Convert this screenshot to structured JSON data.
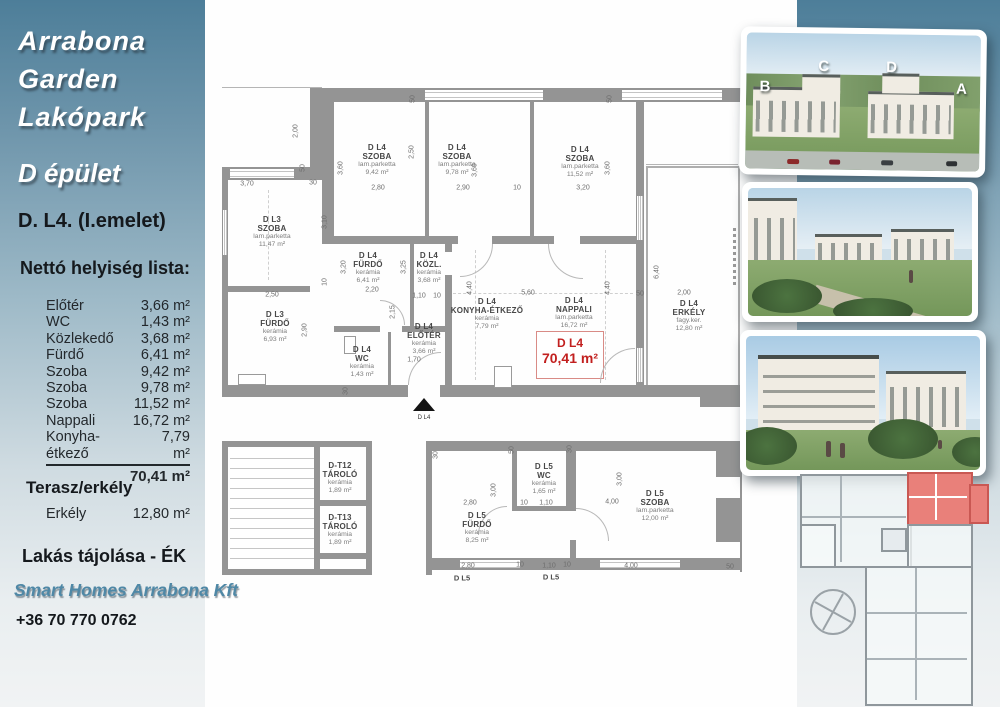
{
  "sidebar": {
    "logo_lines": [
      "Arrabona",
      "Garden",
      "Lakópark"
    ],
    "building": "D épület",
    "unit_title": "D. L4. (I.emelet)",
    "list_title": "Nettó helyiség lista:",
    "rooms": [
      {
        "label": "Előtér",
        "value": "3,66 m²"
      },
      {
        "label": "WC",
        "value": "1,43 m²"
      },
      {
        "label": "Közlekedő",
        "value": "3,68 m²"
      },
      {
        "label": "Fürdő",
        "value": "6,41 m²"
      },
      {
        "label": "Szoba",
        "value": "9,42 m²"
      },
      {
        "label": "Szoba",
        "value": "9,78 m²"
      },
      {
        "label": "Szoba",
        "value": "11,52 m²"
      },
      {
        "label": "Nappali",
        "value": "16,72 m²"
      },
      {
        "label": "Konyha-étkező",
        "value": "7,79 m²"
      }
    ],
    "total": "70,41 m²",
    "terrace_title": "Terasz/erkély",
    "terrace_label": "Erkély",
    "terrace_value": "12,80 m²",
    "orientation": "Lakás tájolása - ÉK",
    "company": "Smart Homes Arrabona Kft",
    "phone": "+36 70 770 0762"
  },
  "floorplan": {
    "unit_box": {
      "line1": "D L4",
      "line2": "70,41 m²"
    },
    "entrance_label": "D L4",
    "rooms": [
      {
        "id": "dl3-szoba",
        "x": 272,
        "y": 232,
        "lines": [
          "D L3",
          "SZOBA",
          "lam.parketta",
          "11,47 m²"
        ]
      },
      {
        "id": "dl4-szoba-1",
        "x": 377,
        "y": 160,
        "lines": [
          "D L4",
          "SZOBA",
          "lam.parketta",
          "9,42 m²"
        ]
      },
      {
        "id": "dl4-szoba-2",
        "x": 457,
        "y": 160,
        "lines": [
          "D L4",
          "SZOBA",
          "lam.parketta",
          "9,78 m²"
        ]
      },
      {
        "id": "dl4-szoba-3",
        "x": 580,
        "y": 162,
        "lines": [
          "D L4",
          "SZOBA",
          "lam.parketta",
          "11,52 m²"
        ]
      },
      {
        "id": "dl3-furdo",
        "x": 275,
        "y": 327,
        "lines": [
          "D L3",
          "FÜRDŐ",
          "kerámia",
          "6,93 m²"
        ]
      },
      {
        "id": "dl4-furdo",
        "x": 368,
        "y": 268,
        "lines": [
          "D L4",
          "FÜRDŐ",
          "kerámia",
          "6,41 m²"
        ]
      },
      {
        "id": "dl4-kozl",
        "x": 429,
        "y": 268,
        "lines": [
          "D L4",
          "KÖZL.",
          "kerámia",
          "3,68 m²"
        ]
      },
      {
        "id": "dl4-wc",
        "x": 362,
        "y": 362,
        "lines": [
          "D L4",
          "WC",
          "kerámia",
          "1,43 m²"
        ]
      },
      {
        "id": "dl4-eloter",
        "x": 424,
        "y": 339,
        "lines": [
          "D L4",
          "ELŐTÉR",
          "kerámia",
          "3,66 m²"
        ]
      },
      {
        "id": "dl4-konyha",
        "x": 487,
        "y": 314,
        "lines": [
          "D L4",
          "KONYHA-ÉTKEZŐ",
          "kerámia",
          "7,79 m²"
        ]
      },
      {
        "id": "dl4-nappali",
        "x": 574,
        "y": 313,
        "lines": [
          "D L4",
          "NAPPALI",
          "lam.parketta",
          "16,72 m²"
        ]
      },
      {
        "id": "dl4-erkely",
        "x": 689,
        "y": 316,
        "lines": [
          "D L4",
          "ERKÉLY",
          "fagy.ker.",
          "12,80 m²"
        ]
      },
      {
        "id": "dt12-tarolo",
        "x": 340,
        "y": 478,
        "lines": [
          "D-T12",
          "TÁROLÓ",
          "kerámia",
          "1,89 m²"
        ]
      },
      {
        "id": "dt13-tarolo",
        "x": 340,
        "y": 530,
        "lines": [
          "D-T13",
          "TÁROLÓ",
          "kerámia",
          "1,89 m²"
        ]
      },
      {
        "id": "dl5-wc",
        "x": 544,
        "y": 479,
        "lines": [
          "D L5",
          "WC",
          "kerámia",
          "1,65 m²"
        ]
      },
      {
        "id": "dl5-furdo",
        "x": 477,
        "y": 528,
        "lines": [
          "D L5",
          "FÜRDŐ",
          "kerámia",
          "8,25 m²"
        ]
      },
      {
        "id": "dl5-szoba",
        "x": 655,
        "y": 506,
        "lines": [
          "D L5",
          "SZOBA",
          "lam.parketta",
          "12,00 m²"
        ]
      }
    ],
    "dims": [
      {
        "t": "3,70",
        "x": 247,
        "y": 184
      },
      {
        "t": "2,00",
        "x": 296,
        "y": 131,
        "r": 1
      },
      {
        "t": "50",
        "x": 303,
        "y": 168,
        "r": 1
      },
      {
        "t": "30",
        "x": 313,
        "y": 183
      },
      {
        "t": "3,60",
        "x": 341,
        "y": 168,
        "r": 1
      },
      {
        "t": "2,80",
        "x": 378,
        "y": 188
      },
      {
        "t": "2,50",
        "x": 412,
        "y": 152,
        "r": 1
      },
      {
        "t": "2,90",
        "x": 463,
        "y": 188
      },
      {
        "t": "3,60",
        "x": 475,
        "y": 170,
        "r": 1
      },
      {
        "t": "50",
        "x": 413,
        "y": 99,
        "r": 1
      },
      {
        "t": "50",
        "x": 610,
        "y": 99,
        "r": 1
      },
      {
        "t": "10",
        "x": 517,
        "y": 188
      },
      {
        "t": "3,20",
        "x": 583,
        "y": 188
      },
      {
        "t": "3,60",
        "x": 608,
        "y": 168,
        "r": 1
      },
      {
        "t": "3,10",
        "x": 325,
        "y": 222,
        "r": 1
      },
      {
        "t": "3,20",
        "x": 344,
        "y": 267,
        "r": 1
      },
      {
        "t": "2,20",
        "x": 372,
        "y": 290
      },
      {
        "t": "3,25",
        "x": 404,
        "y": 267,
        "r": 1
      },
      {
        "t": "1,10",
        "x": 419,
        "y": 296
      },
      {
        "t": "10",
        "x": 437,
        "y": 296
      },
      {
        "t": "2,50",
        "x": 272,
        "y": 295
      },
      {
        "t": "2,90",
        "x": 305,
        "y": 330,
        "r": 1
      },
      {
        "t": "10",
        "x": 325,
        "y": 282,
        "r": 1
      },
      {
        "t": "4,40",
        "x": 470,
        "y": 288,
        "r": 1
      },
      {
        "t": "5,60",
        "x": 528,
        "y": 293
      },
      {
        "t": "4,40",
        "x": 608,
        "y": 288,
        "r": 1
      },
      {
        "t": "6,40",
        "x": 657,
        "y": 272,
        "r": 1
      },
      {
        "t": "50",
        "x": 640,
        "y": 294
      },
      {
        "t": "2,00",
        "x": 684,
        "y": 293
      },
      {
        "t": "2,15",
        "x": 393,
        "y": 312,
        "r": 1
      },
      {
        "t": "1,70",
        "x": 414,
        "y": 360
      },
      {
        "t": "30",
        "x": 346,
        "y": 391,
        "r": 1
      },
      {
        "t": "2,80",
        "x": 470,
        "y": 503
      },
      {
        "t": "3,00",
        "x": 494,
        "y": 490,
        "r": 1
      },
      {
        "t": "1,10",
        "x": 546,
        "y": 503
      },
      {
        "t": "10",
        "x": 524,
        "y": 503
      },
      {
        "t": "4,00",
        "x": 612,
        "y": 502
      },
      {
        "t": "3,00",
        "x": 620,
        "y": 479,
        "r": 1
      },
      {
        "t": "2,80",
        "x": 468,
        "y": 566
      },
      {
        "t": "10",
        "x": 520,
        "y": 565
      },
      {
        "t": "1,10",
        "x": 549,
        "y": 566
      },
      {
        "t": "10",
        "x": 567,
        "y": 565
      },
      {
        "t": "4,00",
        "x": 631,
        "y": 566
      },
      {
        "t": "50",
        "x": 730,
        "y": 567
      },
      {
        "t": "30",
        "x": 436,
        "y": 455,
        "r": 1
      },
      {
        "t": "50",
        "x": 512,
        "y": 450,
        "r": 1
      },
      {
        "t": "30",
        "x": 570,
        "y": 449,
        "r": 1
      }
    ],
    "extra_labels": [
      {
        "t": "D L5",
        "x": 462,
        "y": 578
      },
      {
        "t": "D L5",
        "x": 551,
        "y": 577
      }
    ]
  },
  "photos": [
    {
      "name": "aerial-render",
      "letters": [
        "B",
        "C",
        "D",
        "A"
      ]
    },
    {
      "name": "courtyard-render"
    },
    {
      "name": "street-render"
    }
  ]
}
